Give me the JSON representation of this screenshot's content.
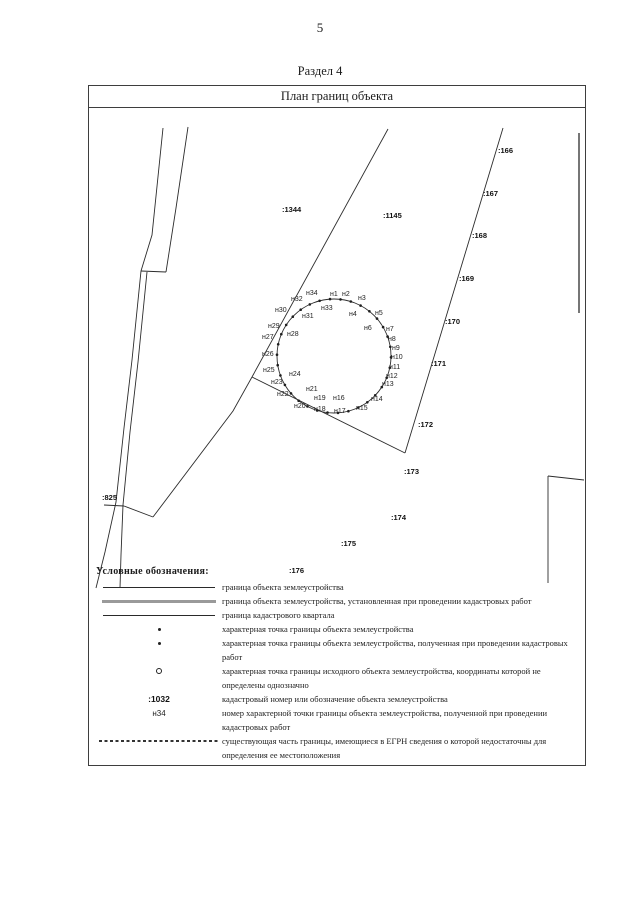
{
  "page": {
    "number": "5",
    "section_title": "Раздел 4"
  },
  "plan_box": {
    "title": "План границ объекта"
  },
  "map": {
    "circle": {
      "cx": 334,
      "cy": 356,
      "r": 57,
      "n_points": 34,
      "start_angle_deg": -4
    },
    "cadastral_labels": [
      {
        "text": ":166",
        "x": 498,
        "y": 146
      },
      {
        "text": ":167",
        "x": 483,
        "y": 189
      },
      {
        "text": ":168",
        "x": 472,
        "y": 231
      },
      {
        "text": ":169",
        "x": 459,
        "y": 274
      },
      {
        "text": ":170",
        "x": 445,
        "y": 317
      },
      {
        "text": ":171",
        "x": 431,
        "y": 359
      },
      {
        "text": ":172",
        "x": 418,
        "y": 420
      },
      {
        "text": ":173",
        "x": 404,
        "y": 467
      },
      {
        "text": ":174",
        "x": 391,
        "y": 513
      },
      {
        "text": ":175",
        "x": 341,
        "y": 539
      },
      {
        "text": ":176",
        "x": 289,
        "y": 566
      },
      {
        "text": ":825",
        "x": 102,
        "y": 493
      },
      {
        "text": ":1344",
        "x": 282,
        "y": 205
      },
      {
        "text": ":1145",
        "x": 383,
        "y": 211
      }
    ],
    "point_labels": [
      {
        "text": "н1",
        "x": 330,
        "y": 291
      },
      {
        "text": "н2",
        "x": 342,
        "y": 291
      },
      {
        "text": "н3",
        "x": 358,
        "y": 295
      },
      {
        "text": "н4",
        "x": 349,
        "y": 311
      },
      {
        "text": "н5",
        "x": 375,
        "y": 310
      },
      {
        "text": "н6",
        "x": 364,
        "y": 325
      },
      {
        "text": "н7",
        "x": 386,
        "y": 326
      },
      {
        "text": "н8",
        "x": 388,
        "y": 336
      },
      {
        "text": "н9",
        "x": 392,
        "y": 345
      },
      {
        "text": "н10",
        "x": 391,
        "y": 354
      },
      {
        "text": "н11",
        "x": 389,
        "y": 364
      },
      {
        "text": "н12",
        "x": 386,
        "y": 373
      },
      {
        "text": "н13",
        "x": 382,
        "y": 381
      },
      {
        "text": "н14",
        "x": 371,
        "y": 396
      },
      {
        "text": "н15",
        "x": 356,
        "y": 405
      },
      {
        "text": "н16",
        "x": 333,
        "y": 395
      },
      {
        "text": "н17",
        "x": 334,
        "y": 408
      },
      {
        "text": "н18",
        "x": 314,
        "y": 406
      },
      {
        "text": "н19",
        "x": 314,
        "y": 395
      },
      {
        "text": "н20",
        "x": 294,
        "y": 403
      },
      {
        "text": "н21",
        "x": 306,
        "y": 386
      },
      {
        "text": "н22",
        "x": 277,
        "y": 391
      },
      {
        "text": "н23",
        "x": 271,
        "y": 379
      },
      {
        "text": "н24",
        "x": 289,
        "y": 371
      },
      {
        "text": "н25",
        "x": 263,
        "y": 367
      },
      {
        "text": "н26",
        "x": 262,
        "y": 351
      },
      {
        "text": "н27",
        "x": 262,
        "y": 334
      },
      {
        "text": "н28",
        "x": 287,
        "y": 331
      },
      {
        "text": "н29",
        "x": 268,
        "y": 323
      },
      {
        "text": "н30",
        "x": 275,
        "y": 307
      },
      {
        "text": "н31",
        "x": 302,
        "y": 313
      },
      {
        "text": "н32",
        "x": 291,
        "y": 296
      },
      {
        "text": "н33",
        "x": 321,
        "y": 305
      },
      {
        "text": "н34",
        "x": 306,
        "y": 290
      }
    ]
  },
  "legend": {
    "header": "Условные обозначения:",
    "items": [
      {
        "text": "граница объекта землеустройства"
      },
      {
        "text": "граница объекта землеустройства, установленная при проведении кадастровых работ"
      },
      {
        "text": "граница кадастрового квартала"
      },
      {
        "text": "характерная точка границы объекта землеустройства"
      },
      {
        "text": "характерная точка границы объекта землеустройства, полученная при проведении кадастровых  работ"
      },
      {
        "text": "характерная точка границы исходного объекта землеустройства, координаты которой не определены  однозначно"
      },
      {
        "symbol_text": ":1032",
        "text": "кадастровый номер или обозначение объекта землеустройства"
      },
      {
        "symbol_text": "н34",
        "text": "номер характерной точки границы объекта землеустройства, полученной при проведении кадастровых  работ"
      },
      {
        "text": "существующая часть границы, имеющиеся в ЕГРН сведения о которой недостаточны для определения  ее местоположения"
      }
    ]
  }
}
